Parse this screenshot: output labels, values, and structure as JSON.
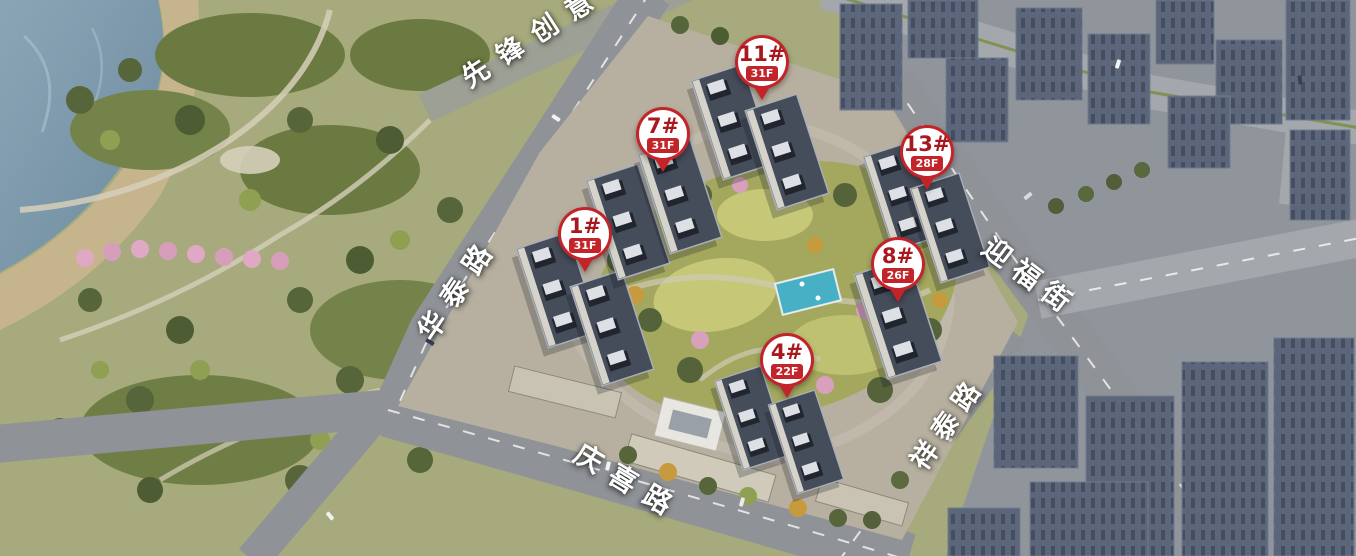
{
  "pins": [
    {
      "label": "1#",
      "floors": "31F"
    },
    {
      "label": "7#",
      "floors": "31F"
    },
    {
      "label": "11#",
      "floors": "31F"
    },
    {
      "label": "13#",
      "floors": "28F"
    },
    {
      "label": "8#",
      "floors": "26F"
    },
    {
      "label": "4#",
      "floors": "22F"
    }
  ],
  "road_labels": [
    {
      "text": "先锋创意"
    },
    {
      "text": "华泰路"
    },
    {
      "text": "迎福街"
    },
    {
      "text": "祥泰路"
    },
    {
      "text": "庆喜路"
    }
  ],
  "colors": {
    "pin_red": "#c3242a",
    "road_label_text": "#ffffff",
    "water": "#7e99ab"
  }
}
